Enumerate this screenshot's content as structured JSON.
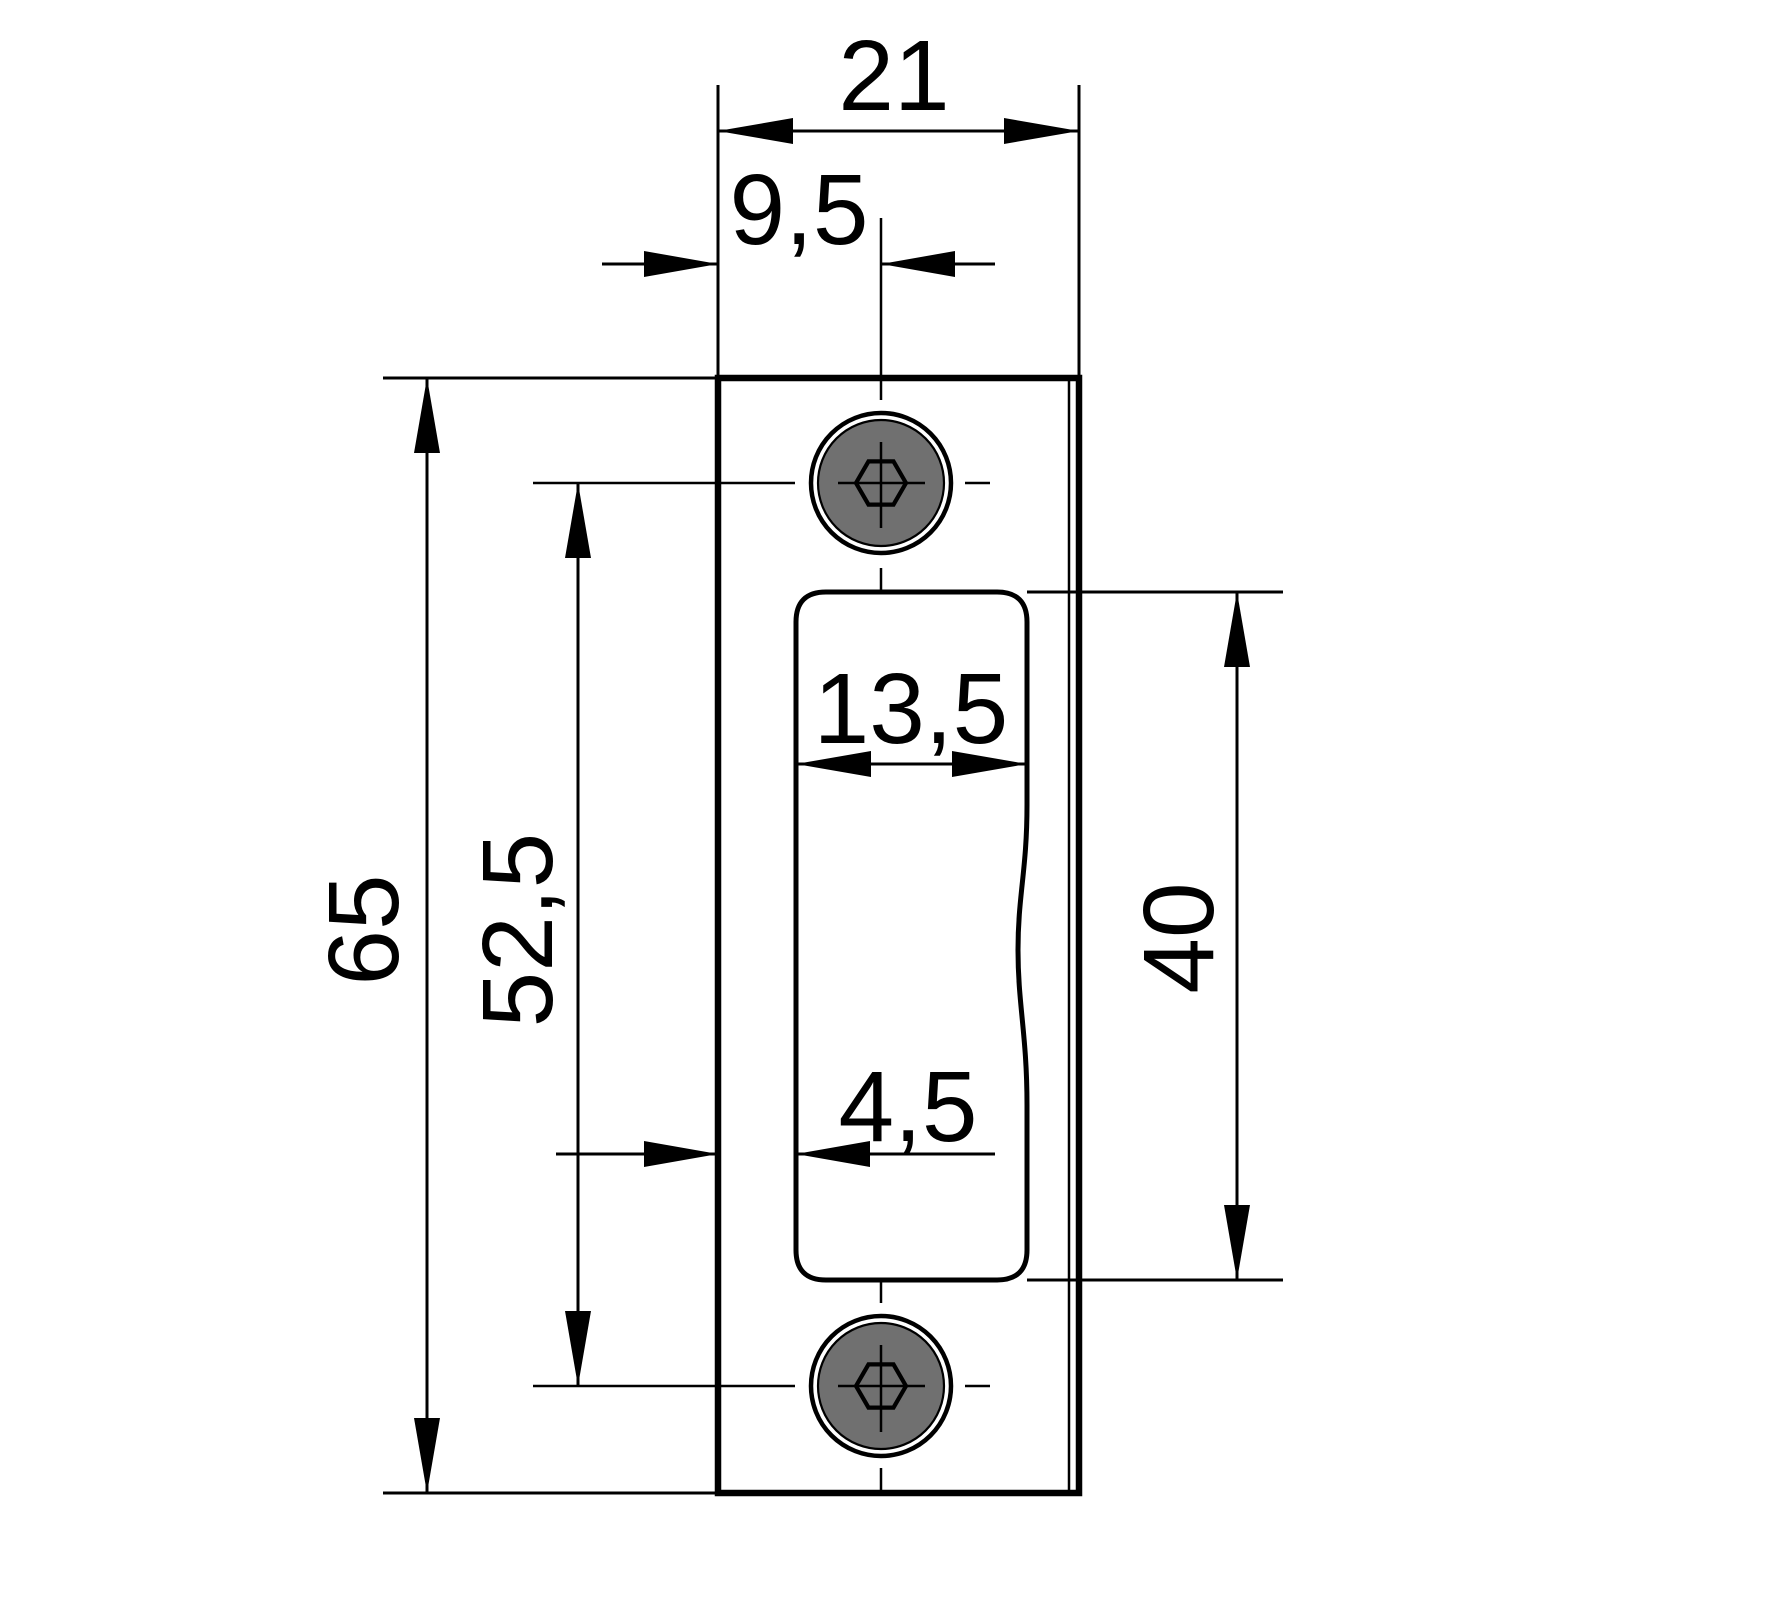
{
  "drawing": {
    "type": "technical-dimension-drawing",
    "subject": "strike-plate-front-view",
    "colors": {
      "background": "#ffffff",
      "plate_fill": "#b3b3b3",
      "screw_fill": "#707070",
      "cutout_fill": "#ffffff",
      "line": "#000000"
    },
    "dimensions": {
      "plate_width": "21",
      "screw_axis_offset": "9,5",
      "cutout_width": "13,5",
      "cutout_offset": "4,5",
      "plate_height": "65",
      "screw_spacing": "52,5",
      "cutout_height": "40"
    }
  }
}
